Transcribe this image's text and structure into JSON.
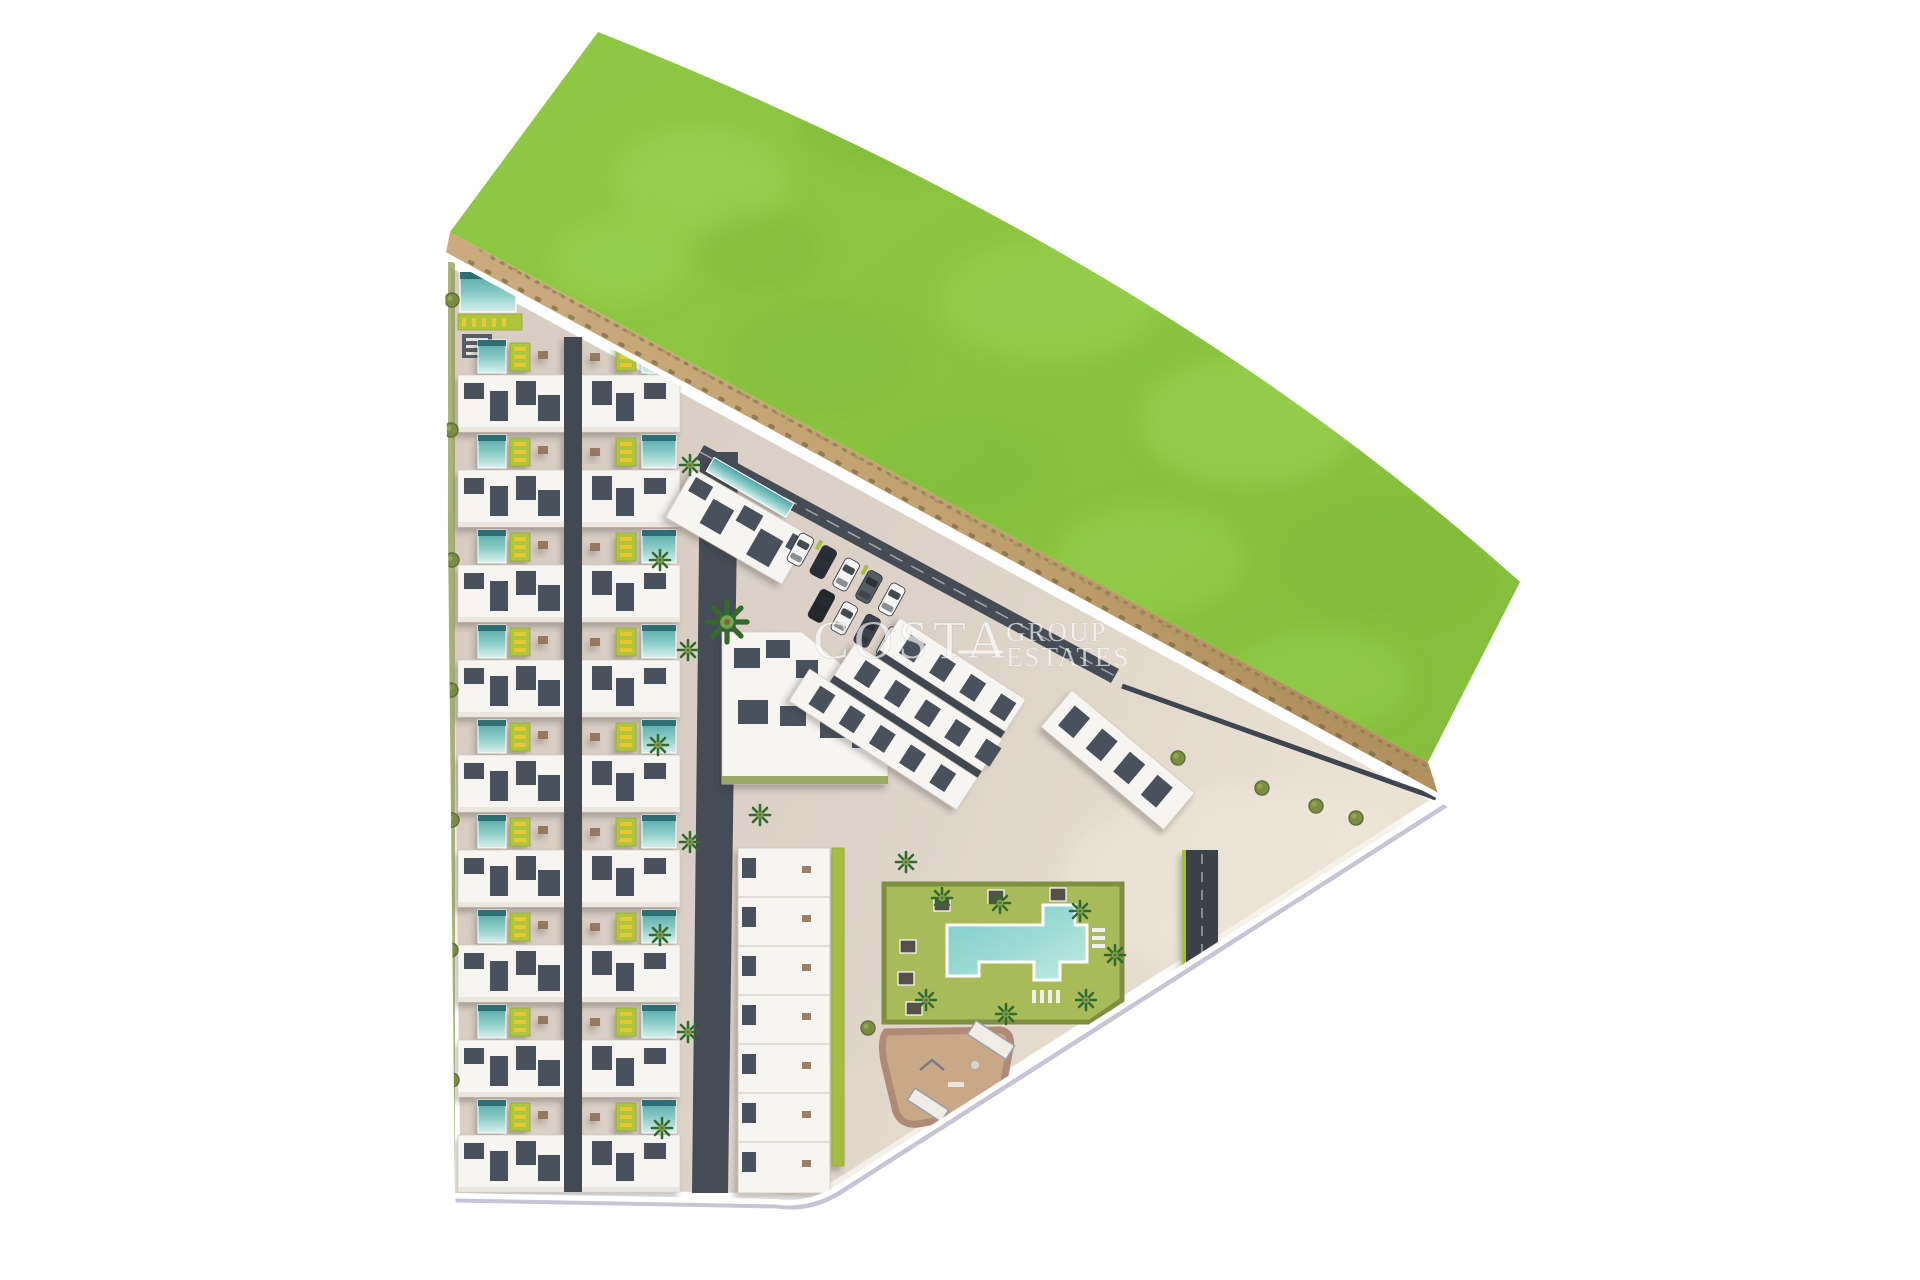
{
  "image": {
    "kind": "aerial-2d-site-plan-render",
    "background": "#ffffff",
    "subject": "coastal residential development masterplan viewed from above"
  },
  "watermark": {
    "line_main": "COSTA",
    "line_top": "GROUP",
    "line_bottom": "ESTATES"
  },
  "palette": {
    "field_green": "#8AC43F",
    "field_green_light": "#9CD653",
    "field_green_dark": "#7CB837",
    "sand": "#C8A877",
    "sand_dark": "#B2905F",
    "paving": "#DAD0C6",
    "paving_light": "#EAE2D4",
    "road_dark": "#454C55",
    "building_white": "#F7F5F1",
    "roof_deck_dark": "#4A515B",
    "pool_teal": "#66B9B4",
    "pool_teal_light": "#CFEAE6",
    "pool_edge_dark": "#2F6E74",
    "lawn_lime": "#AFC53D",
    "garden_olive": "#A9BA59",
    "garden_hedge": "#7E8F3F",
    "lounger_yellow": "#E9C933",
    "playground_tan": "#C9A887",
    "playground_border": "#B08A76",
    "palm_green": "#35692E",
    "edge_white": "#FFFFFF"
  },
  "scene": {
    "grass_field": 1,
    "sand_verge": 1,
    "townhouse_rows": 9,
    "pools_per_townhouse_row": 2,
    "apartment_row_clusters": 3,
    "detached_blocks": 3,
    "communal_pool": 1,
    "communal_garden": 1,
    "playground": 1,
    "parking_cars": 9,
    "palm_trees": 18
  }
}
